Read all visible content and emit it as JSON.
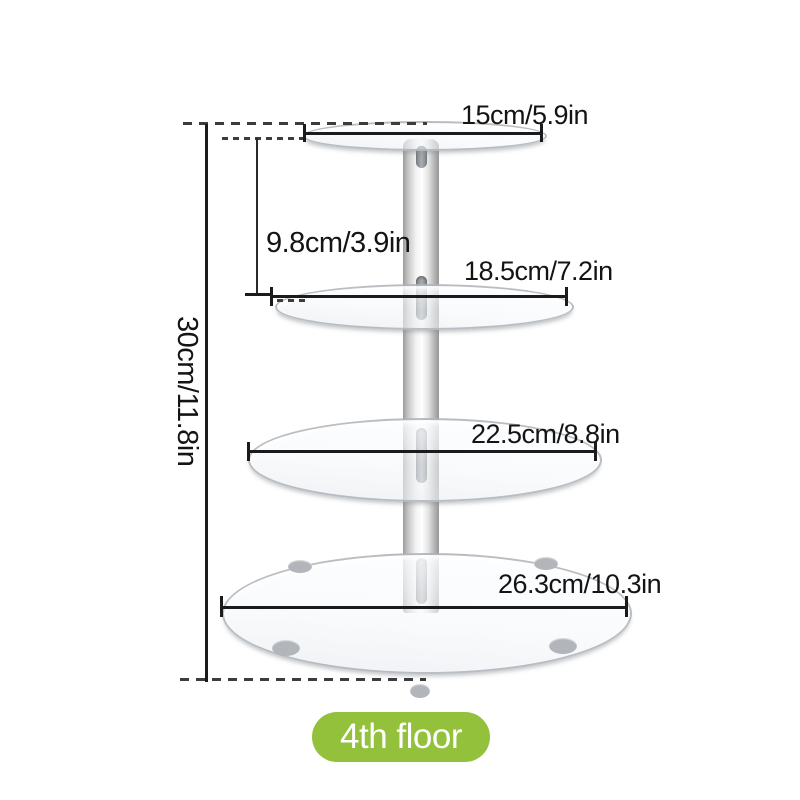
{
  "diagram": {
    "dimensions": {
      "tier1_diameter": "15cm/5.9in",
      "tier2_diameter": "18.5cm/7.2in",
      "tier3_diameter": "22.5cm/8.8in",
      "tier4_diameter": "26.3cm/10.3in",
      "tier_spacing": "9.8cm/3.9in",
      "total_height": "30cm/11.8in"
    },
    "badge": {
      "label": "4th floor",
      "background_color": "#93c13b",
      "text_color": "#ffffff"
    },
    "colors": {
      "background": "#ffffff",
      "dimension_line": "#1b1b1b",
      "pole_silver_light": "#f2f2f2",
      "pole_silver_dark": "#9b9b9b",
      "tier_edge_gray": "#a0a6ab"
    }
  }
}
